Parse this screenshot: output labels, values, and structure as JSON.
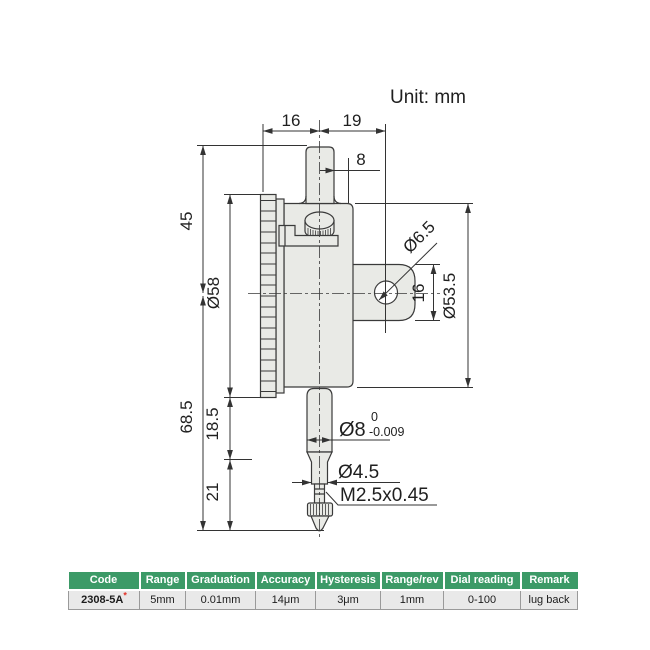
{
  "unit_label": "Unit: mm",
  "dimensions": {
    "top_left_16": "16",
    "top_right_19": "19",
    "stem_dia_8": "8",
    "height_45": "45",
    "bezel_dia": "Ø58",
    "overall_68_5": "68.5",
    "section_18_5": "18.5",
    "section_21": "21",
    "lug_hole_dia": "Ø6.5",
    "lug_width_16": "16",
    "body_dia": "Ø53.5",
    "spindle_dia": "Ø8",
    "spindle_tol_upper": "0",
    "spindle_tol_lower": "-0.009",
    "rod_dia": "Ø4.5",
    "thread_spec": "M2.5x0.45"
  },
  "table": {
    "headers": [
      "Code",
      "Range",
      "Graduation",
      "Accuracy",
      "Hysteresis",
      "Range/rev",
      "Dial reading",
      "Remark"
    ],
    "row": {
      "code": "2308-5A",
      "code_mark": "*",
      "values": [
        "5mm",
        "0.01mm",
        "14μm",
        "3μm",
        "1mm",
        "0-100",
        "lug back"
      ]
    }
  },
  "colors": {
    "header_green": "#3C9A67",
    "star_red": "#E2362B",
    "row_gray": "#E9E9E9",
    "line_dark": "#333333",
    "fill_gray": "#E9EAE6"
  }
}
